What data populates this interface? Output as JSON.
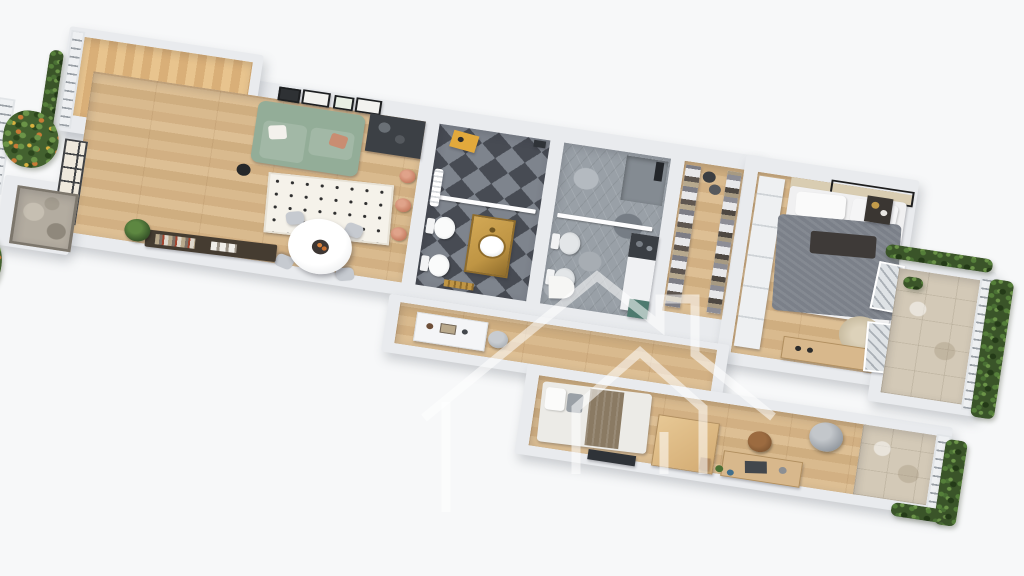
{
  "scene": {
    "type": "3d-floor-plan-render",
    "view": "top-down-axonometric",
    "background": "plain white",
    "rotation_deg": 8.6,
    "watermark": {
      "shape": "house-outline-logo-with-chimney-and-inner-house",
      "color": "rgba(255,255,255,0.55)"
    }
  },
  "apartment": {
    "style": "white cut walls, oak plank flooring",
    "rooms": [
      {
        "id": "terrace",
        "label": "wood deck terrace",
        "items": [
          "wood-decking",
          "white-railing",
          "climbing-vines",
          "black-frame-window-wall"
        ]
      },
      {
        "id": "living-dining",
        "label": "open living and dining room",
        "items": [
          "sage-green-sofa",
          "throw-pillows",
          "gallery-wall-frames",
          "black-floor-plant",
          "beige-floor-lamp",
          "polka-dot-rug",
          "round-white-dining-table",
          "fruit-tray",
          "dining-chairs-x4",
          "dark-sideboard-with-books",
          "potted-plant",
          "stone-entry-mat",
          "dark-kitchenette-counter",
          "copper-pans-x3",
          "tall-black-frame-windows"
        ]
      },
      {
        "id": "bathroom-1",
        "label": "bathroom with black and grey diamond checker tiles",
        "items": [
          "walk-in-shower-glass-screen",
          "gold-vanity-with-round-basin",
          "toilet",
          "bidet",
          "mustard-stool",
          "white-towel-radiator",
          "gold-towel-rail"
        ]
      },
      {
        "id": "bathroom-2",
        "label": "bathroom with grey hexagon tiles",
        "items": [
          "shower-corner-dark-fixture",
          "glass-screen",
          "toilet",
          "bidet",
          "washer-counter-column",
          "teal-cabinet",
          "d-shaped-bath-mat"
        ]
      },
      {
        "id": "walk-in-closet",
        "label": "walk-in closet",
        "items": [
          "open-shelving-left",
          "open-shelving-right",
          "folded-clothes",
          "storage-baskets-x2"
        ]
      },
      {
        "id": "master-bedroom",
        "label": "master bedroom",
        "items": [
          "double-bed-grey-duvet",
          "white-pillows",
          "dark-throw",
          "beige-headboard-wall",
          "black-ceiling-light-frame",
          "dark-nightstand",
          "round-jute-rug",
          "oak-dresser",
          "white-built-in-wardrobe",
          "french-window-doors-x2"
        ]
      },
      {
        "id": "hallway",
        "label": "hallway",
        "items": [
          "white-console-cabinet",
          "round-grey-pouf"
        ]
      },
      {
        "id": "bedroom-2",
        "label": "second bedroom with workspace",
        "items": [
          "single-bed-white-and-brown",
          "oak-wardrobe-box",
          "oak-desk",
          "laptop",
          "brown-desk-chair",
          "grey-papasan-chair",
          "tv-panel",
          "leaning-frame",
          "floor-plants-clutter"
        ]
      },
      {
        "id": "master-balcony",
        "label": "balcony off master bedroom",
        "items": [
          "travertine-tiles",
          "metal-railing",
          "green-hedge",
          "planter"
        ]
      },
      {
        "id": "bedroom2-balcony",
        "label": "balcony off second bedroom",
        "items": [
          "travertine-tiles",
          "metal-railing",
          "green-hedge"
        ]
      },
      {
        "id": "entry-side",
        "label": "entry side planters",
        "items": [
          "white-railing",
          "flowering-shrubs",
          "white-ledge-units",
          "stone-doormat"
        ]
      }
    ]
  },
  "palette": {
    "background": "#f7f8f9",
    "wall": "#e9ebee",
    "wood": "#d8b88c",
    "deck": "#e3bc85",
    "stone": "#b3aca0",
    "travertine": "#d3c9b7",
    "checker_dark": "#474b53",
    "checker_light": "#7e848d",
    "hex": "#99a0a7",
    "sofa": "#93ad98",
    "rug": "#f5f2ea",
    "bed_grey": "#7b8089",
    "green": "#3a5429",
    "flower": "#c97a36",
    "copper": "#c87f64",
    "gold": "#bf9544",
    "yellow": "#e2a93c",
    "teal": "#4e7a6f",
    "dark_unit": "#3c4045"
  }
}
